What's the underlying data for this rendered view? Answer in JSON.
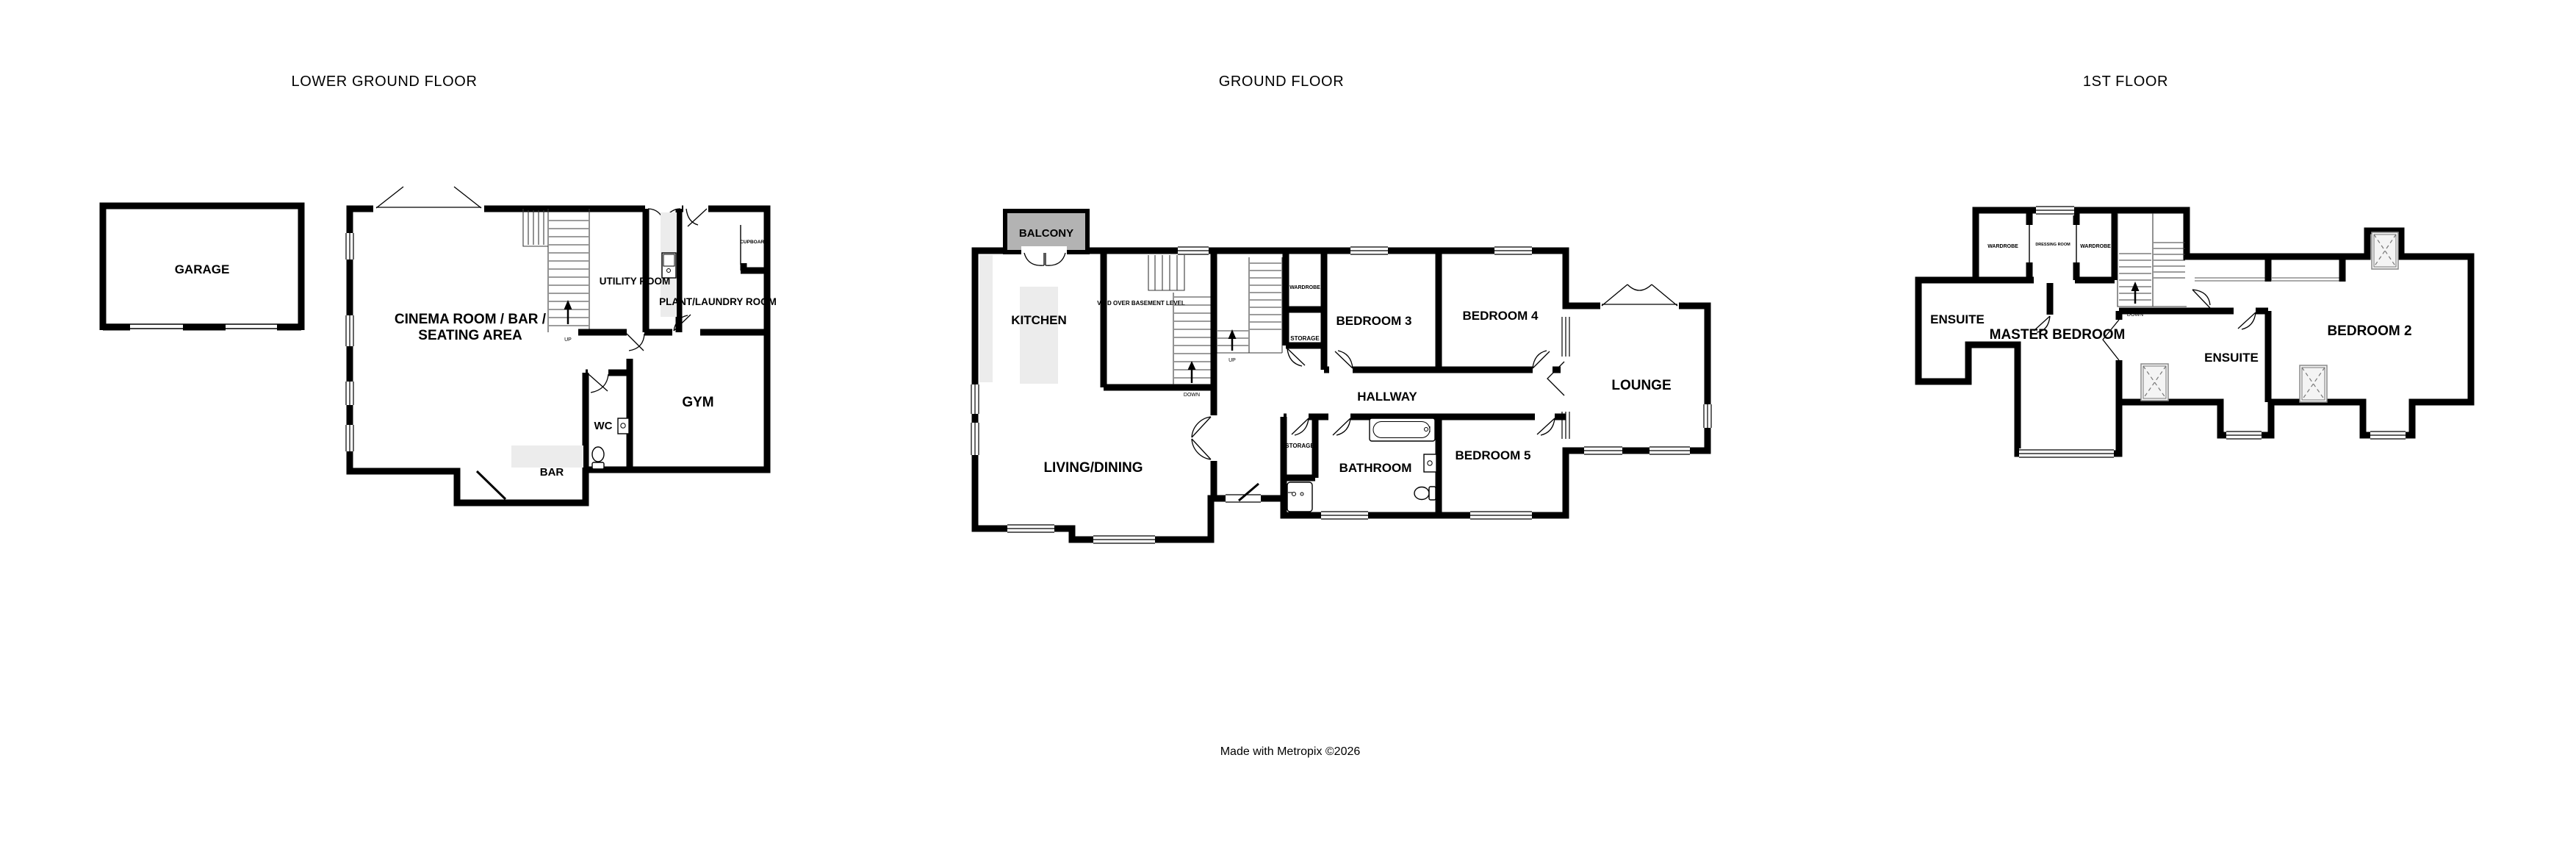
{
  "page": {
    "footer": "Made with Metropix ©2026",
    "background_color": "#ffffff",
    "wall_color": "#000000",
    "balcony_fill": "#b3b3b3",
    "counter_fill": "#ececec"
  },
  "lgf": {
    "title": "LOWER GROUND FLOOR",
    "garage": "GARAGE",
    "cinema_line1": "CINEMA ROOM / BAR /",
    "cinema_line2": "SEATING AREA",
    "utility": "UTILITY ROOM",
    "plant": "PLANT/LAUNDRY ROOM",
    "cupboard": "CUPBOARD",
    "gym": "GYM",
    "wc": "WC",
    "bar": "BAR",
    "up": "UP"
  },
  "gf": {
    "title": "GROUND FLOOR",
    "balcony": "BALCONY",
    "kitchen": "KITCHEN",
    "void": "VOID OVER BASEMENT LEVEL",
    "living": "LIVING/DINING",
    "wardrobe": "WARDROBE",
    "storage_top": "STORAGE",
    "storage_bottom": "STORAGE",
    "bedroom3": "BEDROOM 3",
    "bedroom4": "BEDROOM 4",
    "bedroom5": "BEDROOM 5",
    "hallway": "HALLWAY",
    "bathroom": "BATHROOM",
    "lounge": "LOUNGE",
    "up": "UP",
    "down": "DOWN"
  },
  "ff": {
    "title": "1ST FLOOR",
    "wardrobe_left": "WARDROBE",
    "dressing": "DRESSING ROOM",
    "wardrobe_right": "WARDROBE",
    "ensuite_left": "ENSUITE",
    "master": "MASTER BEDROOM",
    "ensuite_mid": "ENSUITE",
    "bedroom2": "BEDROOM 2",
    "down": "DOWN"
  }
}
